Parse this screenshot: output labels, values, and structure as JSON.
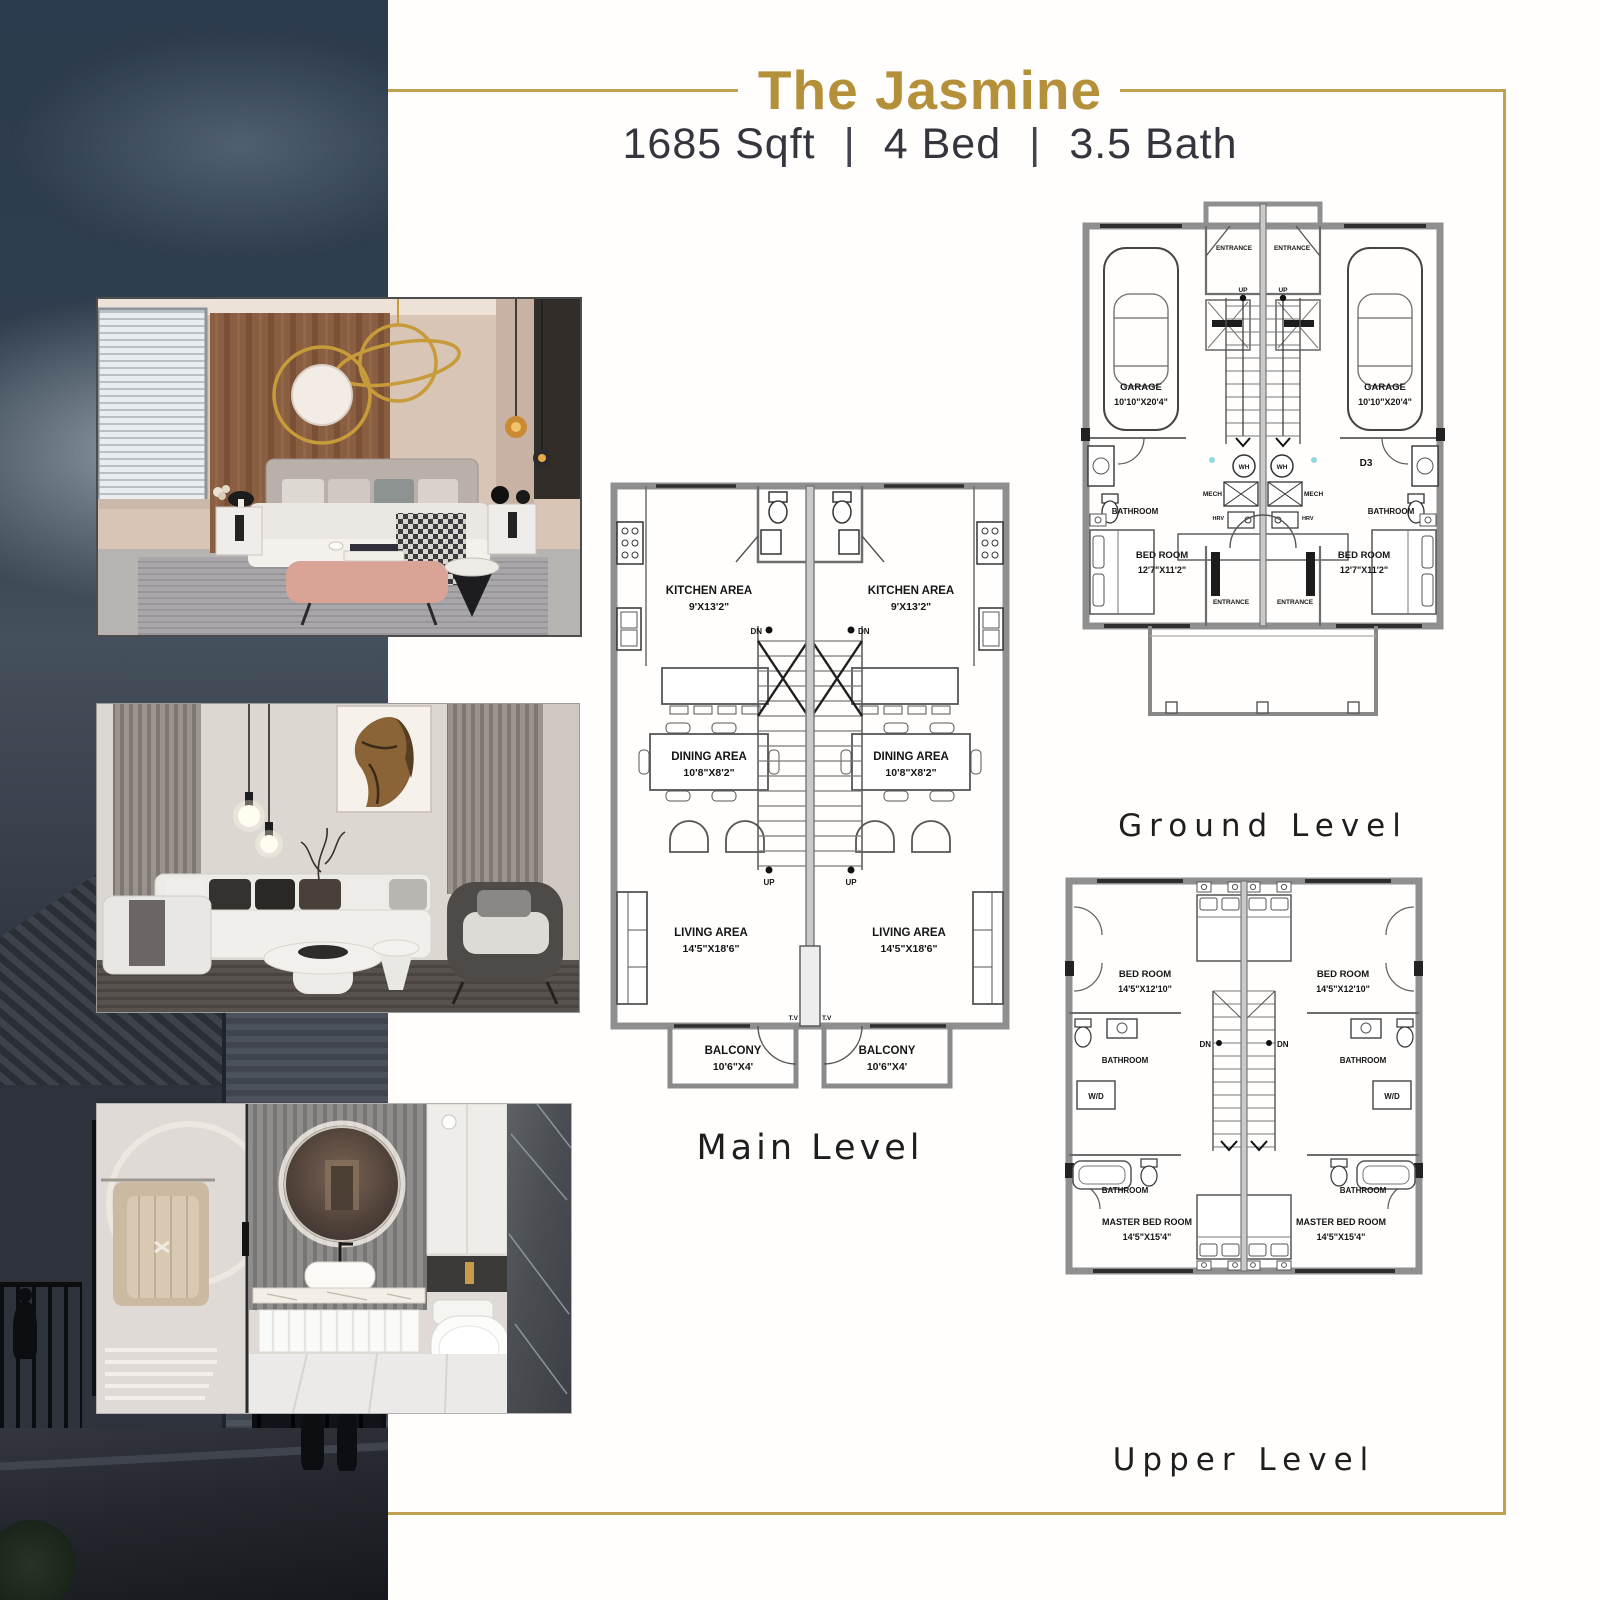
{
  "page": {
    "title": "The Jasmine",
    "subtitle": {
      "sqft": "1685 Sqft",
      "bed": "4 Bed",
      "bath": "3.5 Bath",
      "divider": "|"
    },
    "accent_gold": "#b5903a",
    "frame_gold": "#c0a152"
  },
  "photos": {
    "bedroom_alt": "Primary bedroom interior rendering",
    "living_alt": "Living room interior rendering",
    "bathroom_alt": "Bathroom interior rendering"
  },
  "plans": {
    "main": {
      "caption": "Main Level",
      "kitchen_label": "KITCHEN AREA",
      "kitchen_dims": "9'X13'2\"",
      "dining_label": "DINING AREA",
      "dining_dims": "10'8\"X8'2\"",
      "living_label": "LIVING AREA",
      "living_dims": "14'5\"X18'6\"",
      "balcony_label": "BALCONY",
      "balcony_dims": "10'6\"X4'",
      "up": "UP",
      "dn": "DN",
      "tv": "T.V"
    },
    "ground": {
      "caption": "Ground Level",
      "garage_label": "GARAGE",
      "garage_dims": "10'10\"X20'4\"",
      "entrance": "ENTRANCE",
      "bathroom_label": "BATHROOM",
      "bedroom_label": "BED ROOM",
      "bedroom_dims": "12'7\"X11'2\"",
      "wh": "WH",
      "mech": "MECH",
      "hrv": "HRV",
      "d3": "D3",
      "up": "UP"
    },
    "upper": {
      "caption": "Upper Level",
      "bedroom_label": "BED ROOM",
      "bedroom_dims": "14'5\"X12'10\"",
      "bathroom_label": "BATHROOM",
      "wd": "W/D",
      "master_label": "MASTER BED ROOM",
      "master_dims": "14'5\"X15'4\"",
      "dn": "DN"
    }
  }
}
